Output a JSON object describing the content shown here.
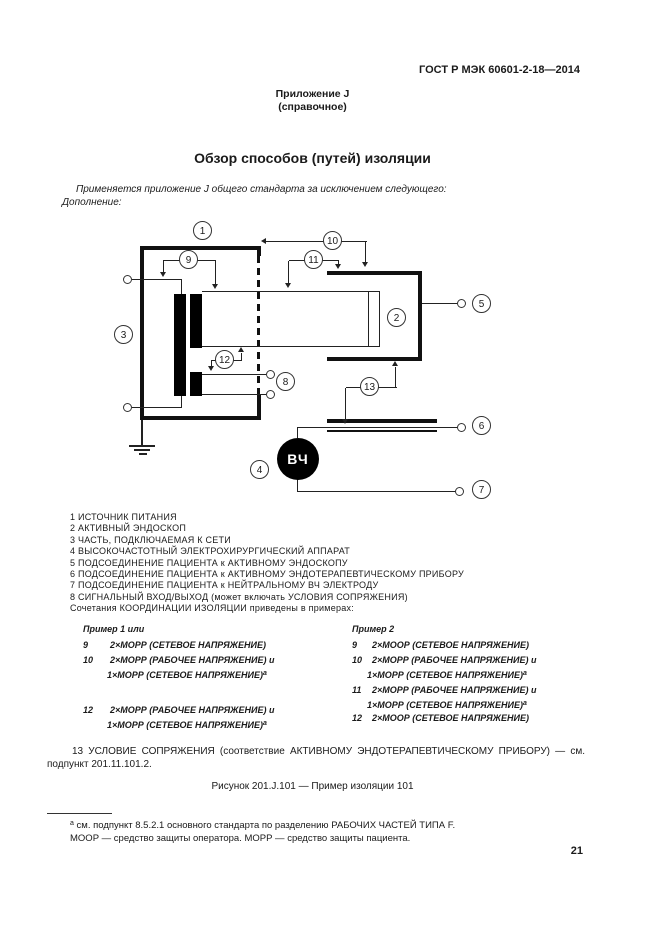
{
  "header": {
    "standard": "ГОСТ Р МЭК 60601-2-18—2014"
  },
  "annex": {
    "name": "Приложение J",
    "type": "(справочное)"
  },
  "title": "Обзор способов (путей) изоляции",
  "intro": {
    "line1": "Применяется приложение J общего стандарта за исключением следующего:",
    "line2": "Дополнение:"
  },
  "diagram": {
    "hf_label": "ВЧ",
    "callouts": {
      "c1": "1",
      "c2": "2",
      "c3": "3",
      "c4": "4",
      "c5": "5",
      "c6": "6",
      "c7": "7",
      "c8": "8",
      "c9": "9",
      "c10": "10",
      "c11": "11",
      "c12": "12",
      "c13": "13"
    }
  },
  "legend": {
    "items": [
      "1 ИСТОЧНИК ПИТАНИЯ",
      "2 АКТИВНЫЙ ЭНДОСКОП",
      "3 ЧАСТЬ, ПОДКЛЮЧАЕМАЯ К СЕТИ",
      "4 ВЫСОКОЧАСТОТНЫЙ ЭЛЕКТРОХИРУРГИЧЕСКИЙ АППАРАТ",
      "5 ПОДСОЕДИНЕНИЕ ПАЦИЕНТА к АКТИВНОМУ ЭНДОСКОПУ",
      "6 ПОДСОЕДИНЕНИЕ ПАЦИЕНТА к АКТИВНОМУ ЭНДОТЕРАПЕВТИЧЕСКОМУ ПРИБОРУ",
      "7 ПОДСОЕДИНЕНИЕ ПАЦИЕНТА к НЕЙТРАЛЬНОМУ ВЧ ЭЛЕКТРОДУ",
      "8 СИГНАЛЬНЫЙ ВХОД/ВЫХОД (может включать УСЛОВИЯ СОПРЯЖЕНИЯ)"
    ],
    "note": "Сочетания КООРДИНАЦИИ ИЗОЛЯЦИИ приведены в примерах:"
  },
  "examples": {
    "col1": {
      "header": "Пример 1 или",
      "rows": [
        {
          "num": "9",
          "line1": "2×МОРР (СЕТЕВОЕ НАПРЯЖЕНИЕ)",
          "line2": "",
          "sup": ""
        },
        {
          "num": "10",
          "line1": "2×МОРР (РАБОЧЕЕ НАПРЯЖЕНИЕ) и",
          "line2": "1×МОРР (СЕТЕВОЕ НАПРЯЖЕНИЕ)",
          "sup": "a"
        },
        {
          "num": "12",
          "line1": "2×МОРР (РАБОЧЕЕ НАПРЯЖЕНИЕ) и",
          "line2": "1×МОРР (СЕТЕВОЕ НАПРЯЖЕНИЕ)",
          "sup": "a"
        }
      ]
    },
    "col2": {
      "header": "Пример 2",
      "rows": [
        {
          "num": "9",
          "line1": "2×МООР (СЕТЕВОЕ НАПРЯЖЕНИЕ)",
          "line2": "",
          "sup": ""
        },
        {
          "num": "10",
          "line1": "2×МОРР (РАБОЧЕЕ НАПРЯЖЕНИЕ) и",
          "line2": "1×МОРР (СЕТЕВОЕ НАПРЯЖЕНИЕ)",
          "sup": "a"
        },
        {
          "num": "11",
          "line1": "2×МОРР (РАБОЧЕЕ НАПРЯЖЕНИЕ) и",
          "line2": "1×МОРР (СЕТЕВОЕ НАПРЯЖЕНИЕ)",
          "sup": "a"
        },
        {
          "num": "12",
          "line1": "2×МООР (СЕТЕВОЕ НАПРЯЖЕНИЕ)",
          "line2": "",
          "sup": ""
        }
      ]
    }
  },
  "coupling_note": "13 УСЛОВИЕ СОПРЯЖЕНИЯ (соответствие АКТИВНОМУ ЭНДОТЕРАПЕВТИЧЕСКОМУ ПРИБОРУ) — см. подпункт 201.11.101.2.",
  "figure_caption": "Рисунок 201.J.101 — Пример изоляции 101",
  "footnote": {
    "marker": "a",
    "line1": "см. подпункт 8.5.2.1 основного стандарта по разделению РАБОЧИХ ЧАСТЕЙ ТИПА F.",
    "line2": "МООР — средство защиты оператора. МОРР — средство защиты пациента."
  },
  "page": {
    "number": "21"
  }
}
